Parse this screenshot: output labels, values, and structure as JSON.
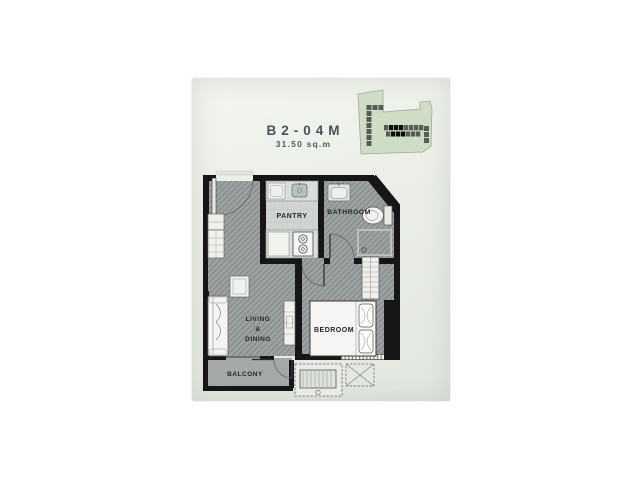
{
  "photo": {
    "unit_title": "B2-04M",
    "unit_area": "31.50 sq.m"
  },
  "rooms": {
    "pantry": "PANTRY",
    "bathroom": "BATHROOM",
    "living1": "LIVING",
    "living2": "&",
    "living3": "DINING",
    "bedroom": "BEDROOM",
    "balcony": "BALCONY"
  },
  "keyplan": {
    "icon": "building-site-keyplan",
    "building_color": "#cfdcc6",
    "unit_color": "#575c55",
    "highlight_color": "#0b0b0b"
  },
  "fixtures": [
    "entry-door",
    "refrigerator-cabinet",
    "kitchen-counter",
    "kitchen-sink",
    "stove",
    "bathroom-sink",
    "toilet",
    "shower",
    "bathroom-door",
    "bedroom-door",
    "sofa",
    "side-table",
    "tv-console",
    "bed",
    "pillows",
    "wardrobe",
    "sliding-door",
    "balcony-door",
    "ac-condenser-unit",
    "ac-ledge"
  ],
  "colors": {
    "paper": "#eaeee6",
    "wall": "#161616",
    "floor": "#9fa4a3",
    "floor_stripe": "#8a908f",
    "pantry_floor": "#d0d4d1",
    "balcony_floor": "#a4a8a6",
    "furniture_fill": "#f4f5f2",
    "title_text": "#46525e",
    "label_text": "#23282e"
  }
}
